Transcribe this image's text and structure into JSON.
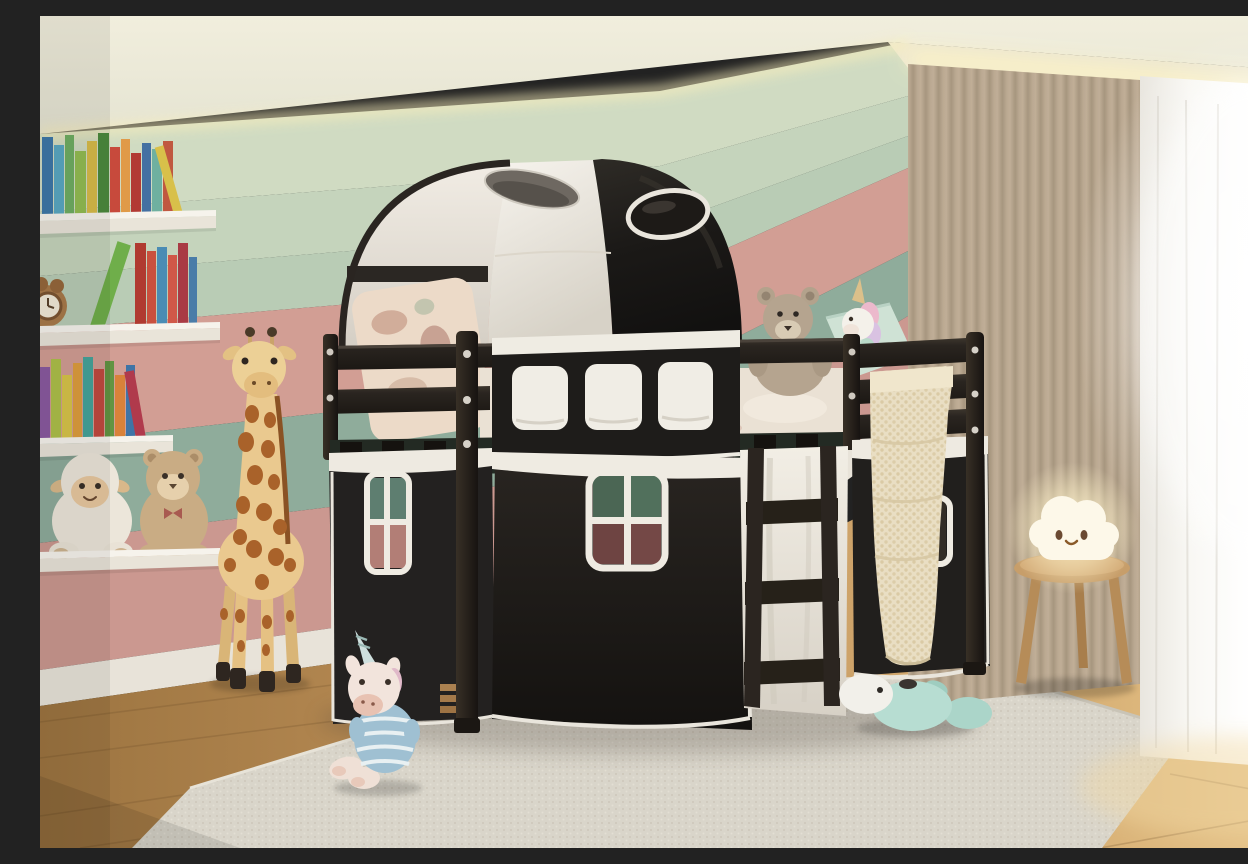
{
  "scene": {
    "description": "3D-rendered children's bedroom: pastel striped wall, white floating shelves with colorful books and plush toys, tall giraffe plush, black wooden loft bed with black-and-white play tent canopy and curtain skirt with white framed windows, ladder, knit blanket, beige drape and bright sheer window curtain, wooden stool with glowing cloud lamp, plush toys on a pale rug over a wood floor.",
    "type": "photograph-recreation",
    "room": "kids bedroom"
  },
  "palette": {
    "ceiling": "#eeebdb",
    "cove_glow": "#f8eec0",
    "wall_green_top": "#d0dbc2",
    "wall_green_mid": "#c5d4bc",
    "wall_sage": "#b9ccb5",
    "wall_pink": "#d29e94",
    "wall_green_band": "#8fac9b",
    "wall_pink_lower": "#cb9890",
    "baseboard": "#e8e3d9",
    "floor_wood": "#c0925a",
    "rug": "#d9d5ca",
    "bed_frame": "#26221e",
    "tent_white": "#f2eee6",
    "tent_black": "#1b1917",
    "curtain_black": "#211f1c",
    "trim_white": "#efebe2",
    "pane_green": "#4b6654",
    "pane_maroon": "#6e4442",
    "pane_teal": "#5e7e70",
    "pane_rose": "#b27e76",
    "drape_beige": "#c4b49c",
    "sheer_white": "#f6f4ef",
    "blanket_knit": "#e9dec2",
    "stool_wood": "#c79e6a",
    "lamp_glow": "#fff3cf",
    "giraffe_body": "#eac98f",
    "giraffe_patch": "#a9622a",
    "plush_mint": "#b7ddd2",
    "pillow_mint": "#cfe2d5",
    "book_colors": [
      "#3e78a8",
      "#5aa8c2",
      "#6fae62",
      "#93bd52",
      "#d8bc4a",
      "#4c8a3e",
      "#c74a3c",
      "#e09a48",
      "#b23a34",
      "#4470a2",
      "#6fb0a0",
      "#c05840",
      "#6fae4a",
      "#8a5aa0",
      "#aec04a",
      "#46a49a",
      "#de9e3e"
    ]
  },
  "objects": {
    "ceiling": "ceiling with warm cove lighting",
    "wall": "pastel striped wall",
    "baseboard": "white baseboard",
    "floor": "wooden plank floor",
    "rug": "pale woven area rug",
    "shelves": "white floating wall shelves",
    "books": "colorful children's books",
    "toy_clock": "bear-shaped toy clock",
    "plush_lamb": "plush lamb on shelf",
    "plush_teddy_shelf": "plush teddy on shelf",
    "giraffe_plush": "tall standing giraffe plush",
    "loft_bed": "black wooden loft bed",
    "bed_tent": "black and white arched play tent canopy",
    "tent_handle_white": "oval handle opening in white tent half",
    "tent_handle_black": "oval handle opening in black tent half",
    "floral_pillow": "floral pillow on upper bunk",
    "guardrail": "upper bunk guardrail",
    "valance": "black valance with three white fabric windows",
    "bedding": "white floral duvet",
    "teddy_bed": "teddy bear sitting on bed",
    "pillow_mint": "mint green cushion",
    "unicorn_bed": "small unicorn plush on bed",
    "footboard": "slatted footboard end",
    "under_deck": "open space under bed deck",
    "curtain_left": "black side curtain with small window",
    "curtain_front": "black front curtain with four-pane window",
    "curtain_right": "black right curtain with window",
    "ladder_panel": "white fabric panel behind ladder",
    "ladder": "wooden bed ladder",
    "knit_blanket": "cream waffle-knit blanket draped over rail",
    "bed_posts": "bed corner posts",
    "drape": "beige blackout curtain",
    "sheer": "bright sheer window curtain",
    "stool": "round three-legged wooden stool",
    "cloud_lamp": "glowing smiling cloud lamp",
    "unicorn_floor": "unicorn plush in striped shirt on floor",
    "whale_floor": "mint whale plush on rug"
  }
}
